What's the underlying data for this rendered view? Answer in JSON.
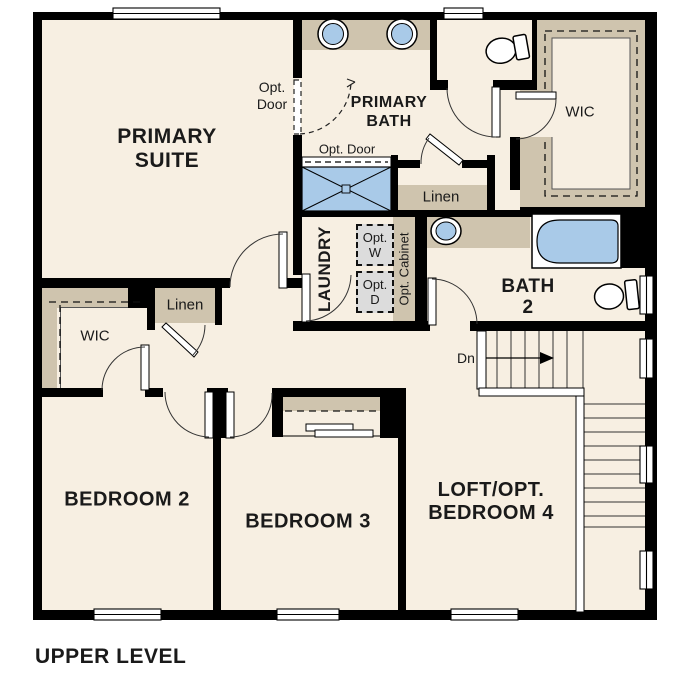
{
  "title": "UPPER LEVEL",
  "colors": {
    "floor": "#f7efe2",
    "cabinet_tan": "#cfc4ae",
    "fixture_blue": "#a9cae8",
    "wall": "#000000",
    "appliance_gray": "#dcdcdc",
    "background": "#ffffff",
    "text": "#1a1a1a"
  },
  "rooms": {
    "primary_suite": {
      "line1": "PRIMARY",
      "line2": "SUITE"
    },
    "primary_bath": {
      "line1": "PRIMARY",
      "line2": "BATH"
    },
    "primary_wic": {
      "label": "WIC"
    },
    "bath_linen": {
      "label": "Linen"
    },
    "hall_linen": {
      "label": "Linen"
    },
    "laundry": {
      "label": "LAUNDRY"
    },
    "bath2": {
      "line1": "BATH",
      "line2": "2"
    },
    "bedroom2": {
      "label": "BEDROOM 2"
    },
    "bedroom2_wic": {
      "label": "WIC"
    },
    "bedroom3": {
      "label": "BEDROOM 3"
    },
    "loft": {
      "line1": "LOFT/OPT.",
      "line2": "BEDROOM 4"
    }
  },
  "annotations": {
    "opt_door_bath_entry": {
      "line1": "Opt.",
      "line2": "Door"
    },
    "opt_door_shower": {
      "label": "Opt. Door"
    },
    "opt_washer": {
      "line1": "Opt.",
      "line2": "W"
    },
    "opt_dryer": {
      "line1": "Opt.",
      "line2": "D"
    },
    "opt_cabinet": {
      "label": "Opt. Cabinet"
    },
    "stairs_down": {
      "label": "Dn"
    }
  }
}
